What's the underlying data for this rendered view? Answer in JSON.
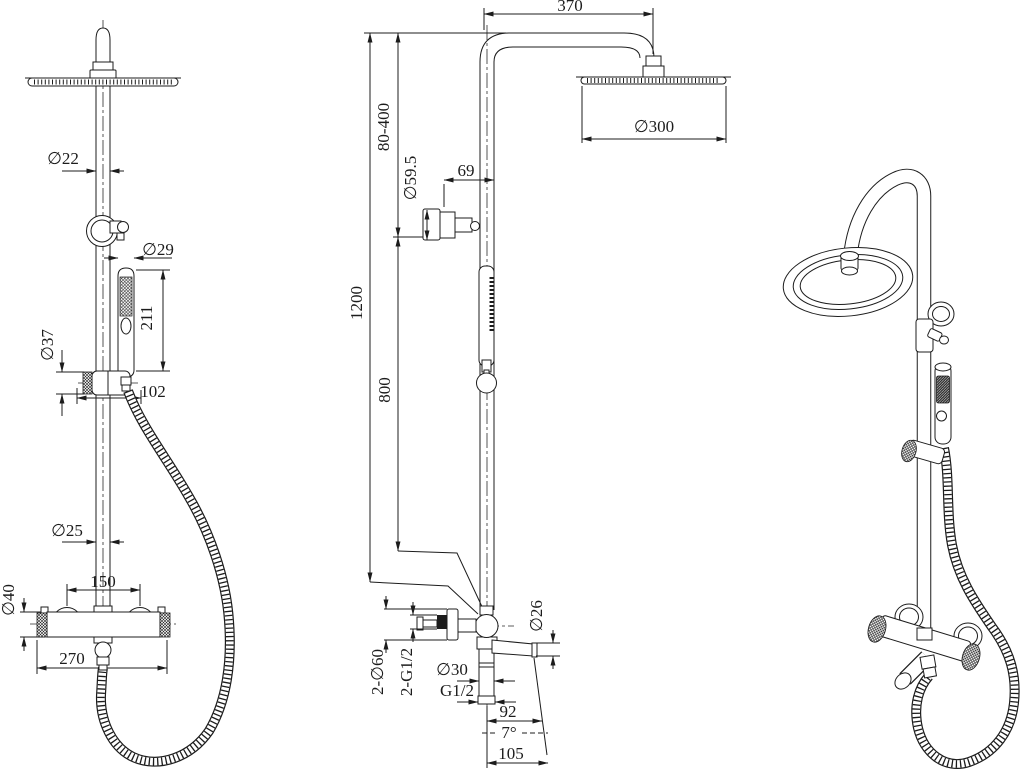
{
  "colors": {
    "background": "#ffffff",
    "line": "#1c1c1c"
  },
  "dims": {
    "front": {
      "top_pipe": "∅22",
      "handset": "∅29",
      "handset_length": "211",
      "slider": "∅37",
      "slider_span": "102",
      "riser": "∅25",
      "valve_body": "∅40",
      "mount_centers": "150",
      "valve_width": "270"
    },
    "side": {
      "arm_reach": "370",
      "adjust_range": "80-400",
      "head": "∅300",
      "wall_flange": "∅59.5",
      "wall_offset": "69",
      "total_height": "1200",
      "riser_height": "800",
      "escutcheon": "2-∅60",
      "inlet_thread": "2-G1/2",
      "bottom_pipe": "∅30",
      "outlet_thread": "G1/2",
      "spout_dia": "∅26",
      "spout_reach": "92",
      "spout_angle": "7°",
      "spout_total": "105"
    }
  }
}
